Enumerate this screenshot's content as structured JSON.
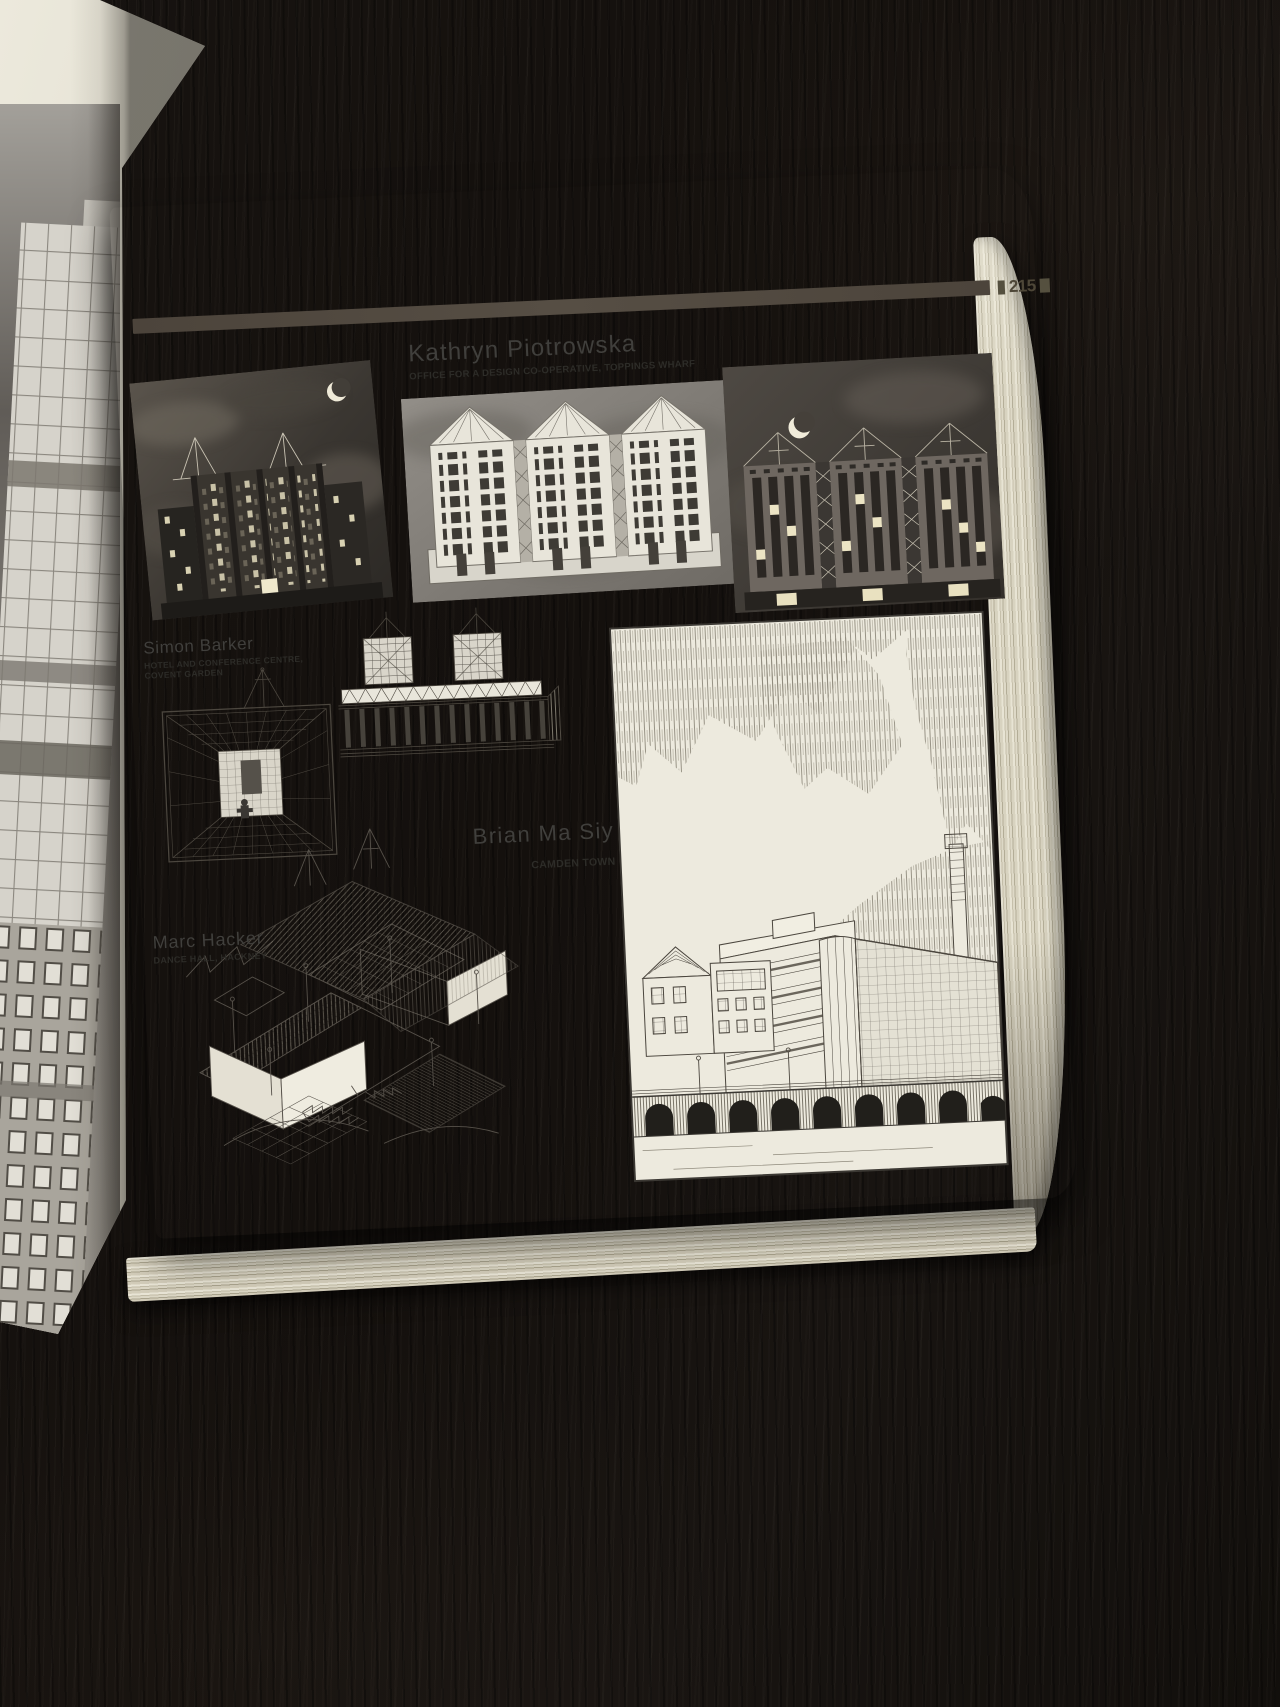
{
  "page": {
    "number": "215",
    "artists": [
      {
        "name": "Kathryn Piotrowska",
        "project": "OFFICE FOR A DESIGN CO-OPERATIVE, TOPPINGS WHARF"
      },
      {
        "name": "Simon Barker",
        "project_line1": "HOTEL AND CONFERENCE CENTRE,",
        "project_line2": "COVENT GARDEN"
      },
      {
        "name": "Brian Ma Siy",
        "project": "CAMDEN TOWN"
      },
      {
        "name": "Marc Hacker",
        "project": "DANCE HALL, HACKNEY"
      }
    ]
  },
  "figures": [
    {
      "id": "night-elevation-left",
      "caption": ""
    },
    {
      "id": "night-elevation-centre",
      "caption": ""
    },
    {
      "id": "night-elevation-right",
      "caption": ""
    },
    {
      "id": "hotel-interior-perspective",
      "caption": ""
    },
    {
      "id": "hotel-street-elevation",
      "caption": ""
    },
    {
      "id": "camden-town-perspective",
      "caption": ""
    },
    {
      "id": "dance-hall-axonometric",
      "caption": ""
    },
    {
      "id": "left-page-tower-photo",
      "caption": ""
    }
  ],
  "icons": {
    "moon_left": "crescent-moon-icon",
    "moon_right": "crescent-moon-icon"
  },
  "colors": {
    "desk": "#16120e",
    "paper": "#edeadd",
    "ink_bar": "#4e463c",
    "night_sky": "#3c3833",
    "heading_ink": "#403f3c",
    "subtitle_ink": "#2d2c28"
  }
}
